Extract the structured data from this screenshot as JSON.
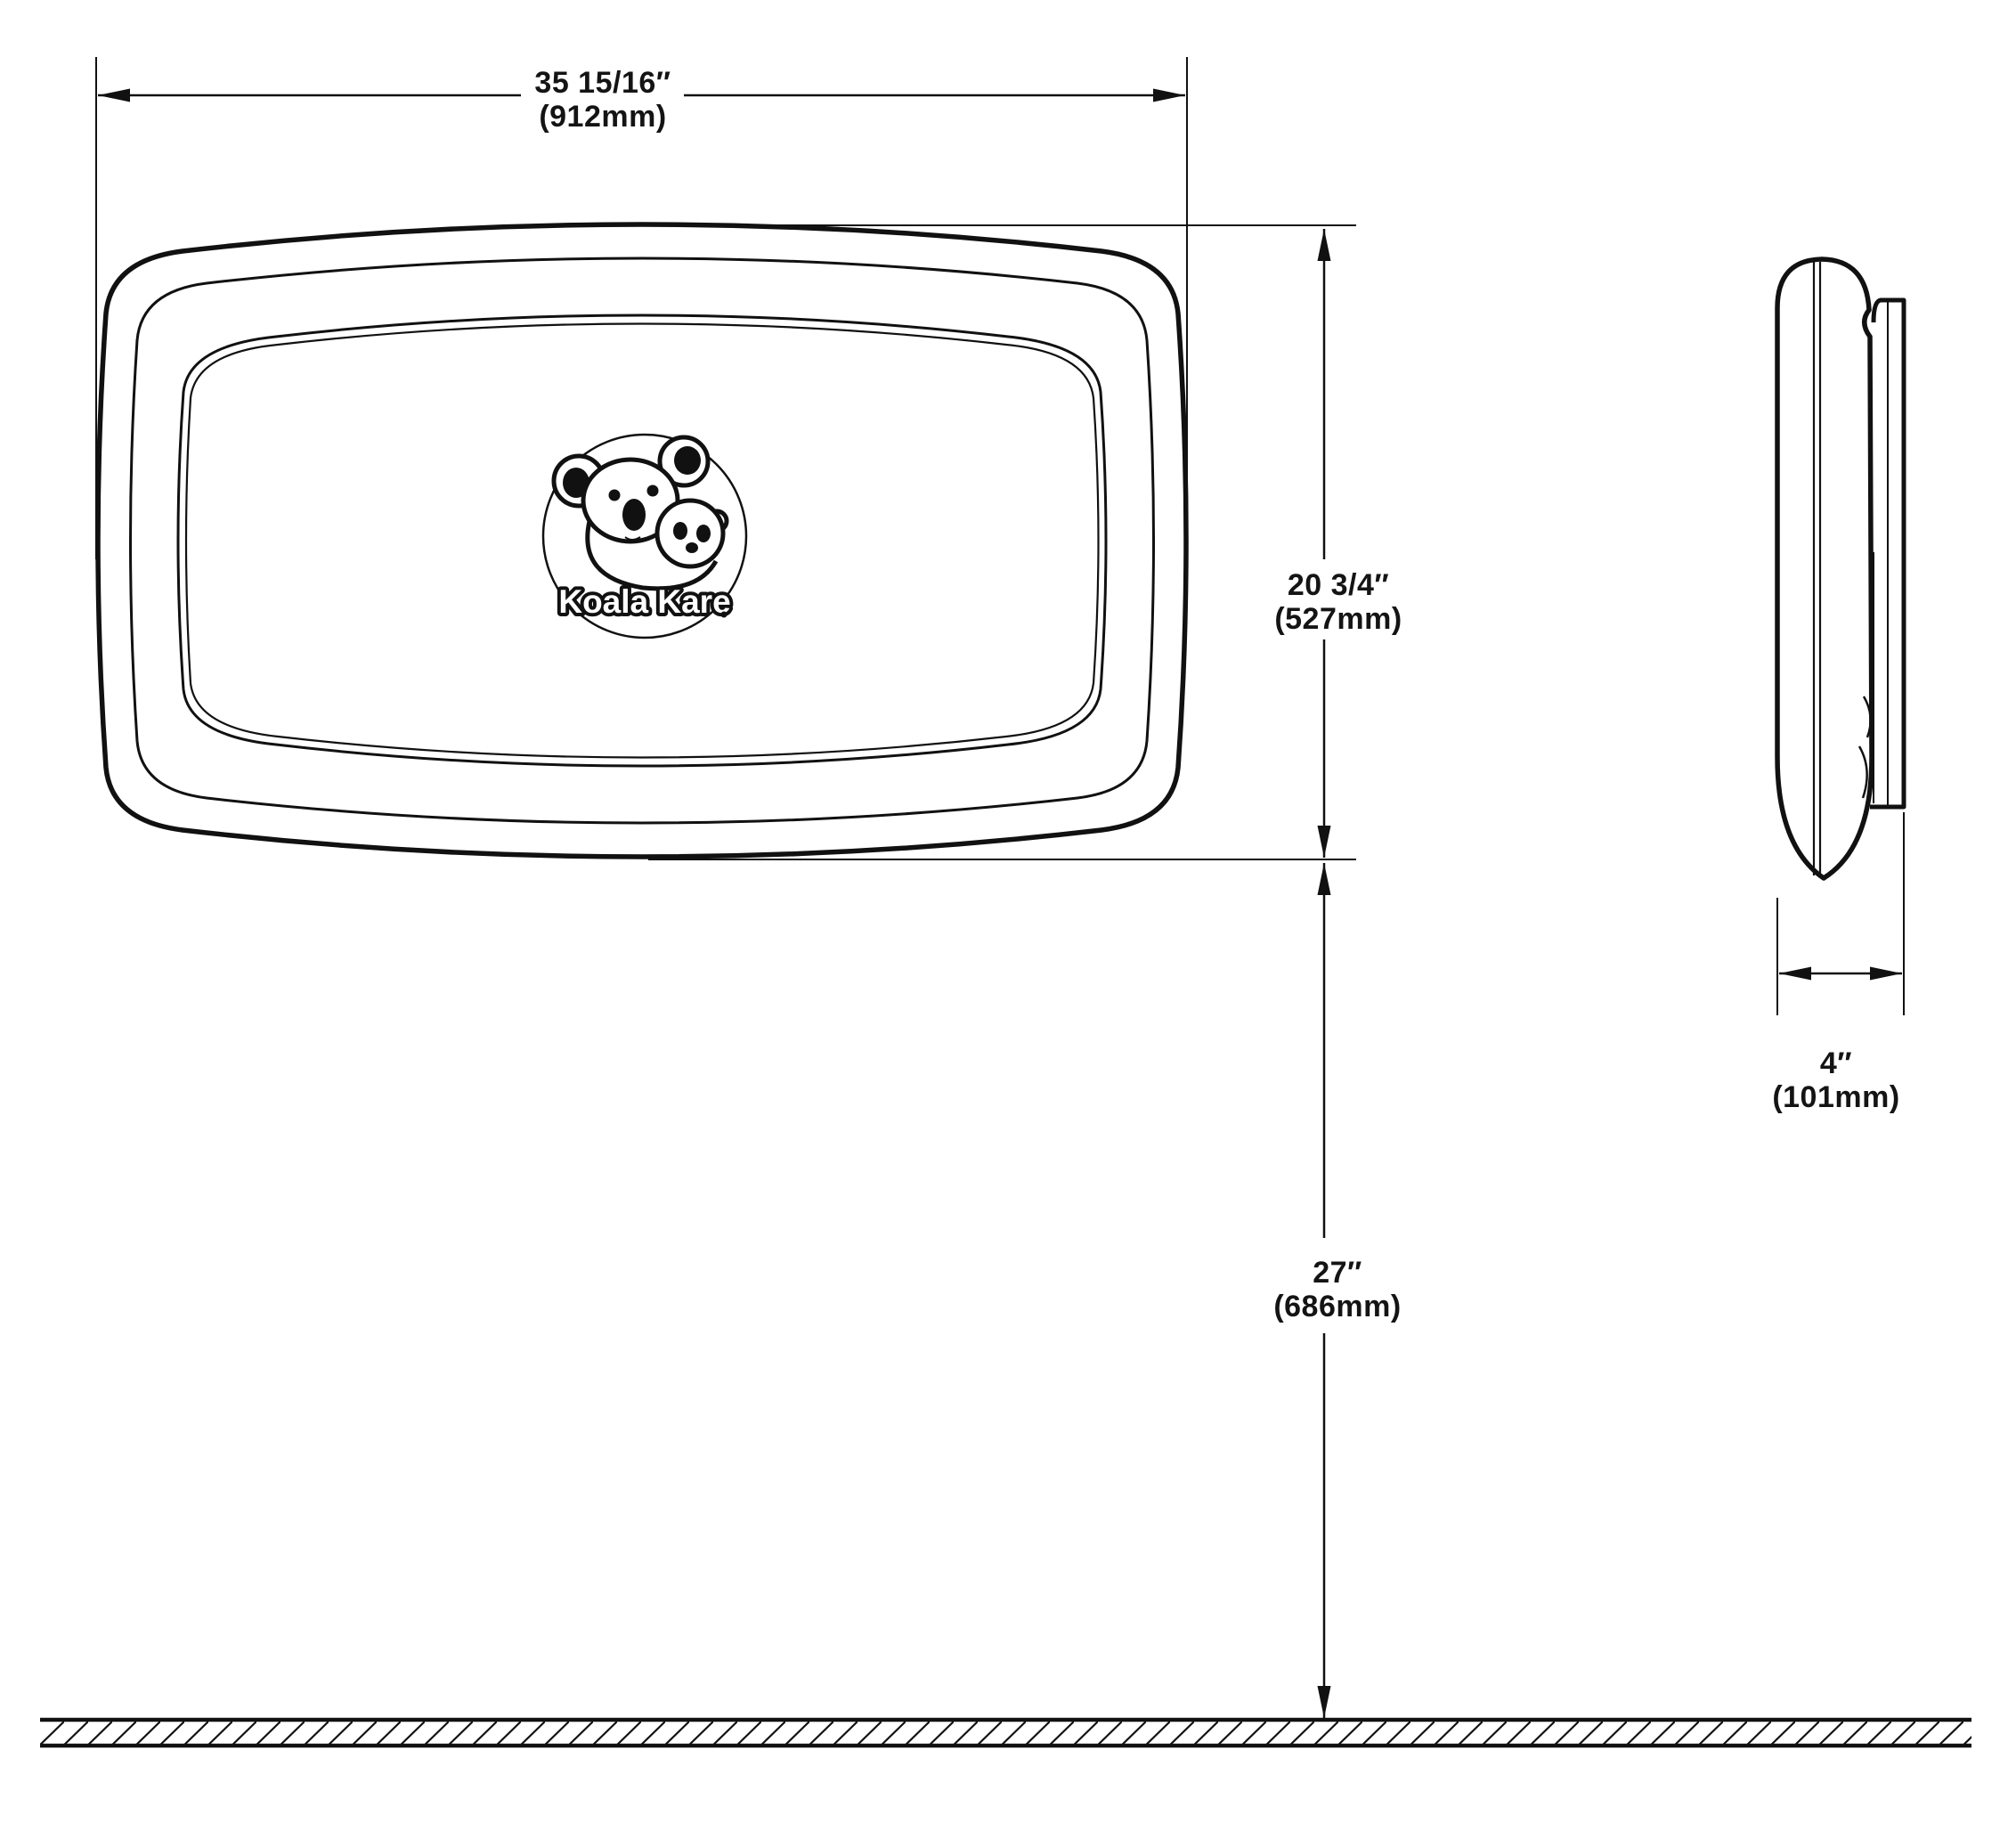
{
  "drawing": {
    "logo": {
      "brand": "Koala Kare"
    },
    "dims": {
      "width_in": "35 15/16″",
      "width_mm": "(912mm)",
      "height_in": "20 3/4″",
      "height_mm": "(527mm)",
      "floor_in": "27″",
      "floor_mm": "(686mm)",
      "depth_in": "4″",
      "depth_mm": "(101mm)"
    },
    "colors": {
      "line": "#111111",
      "background": "#ffffff"
    }
  }
}
